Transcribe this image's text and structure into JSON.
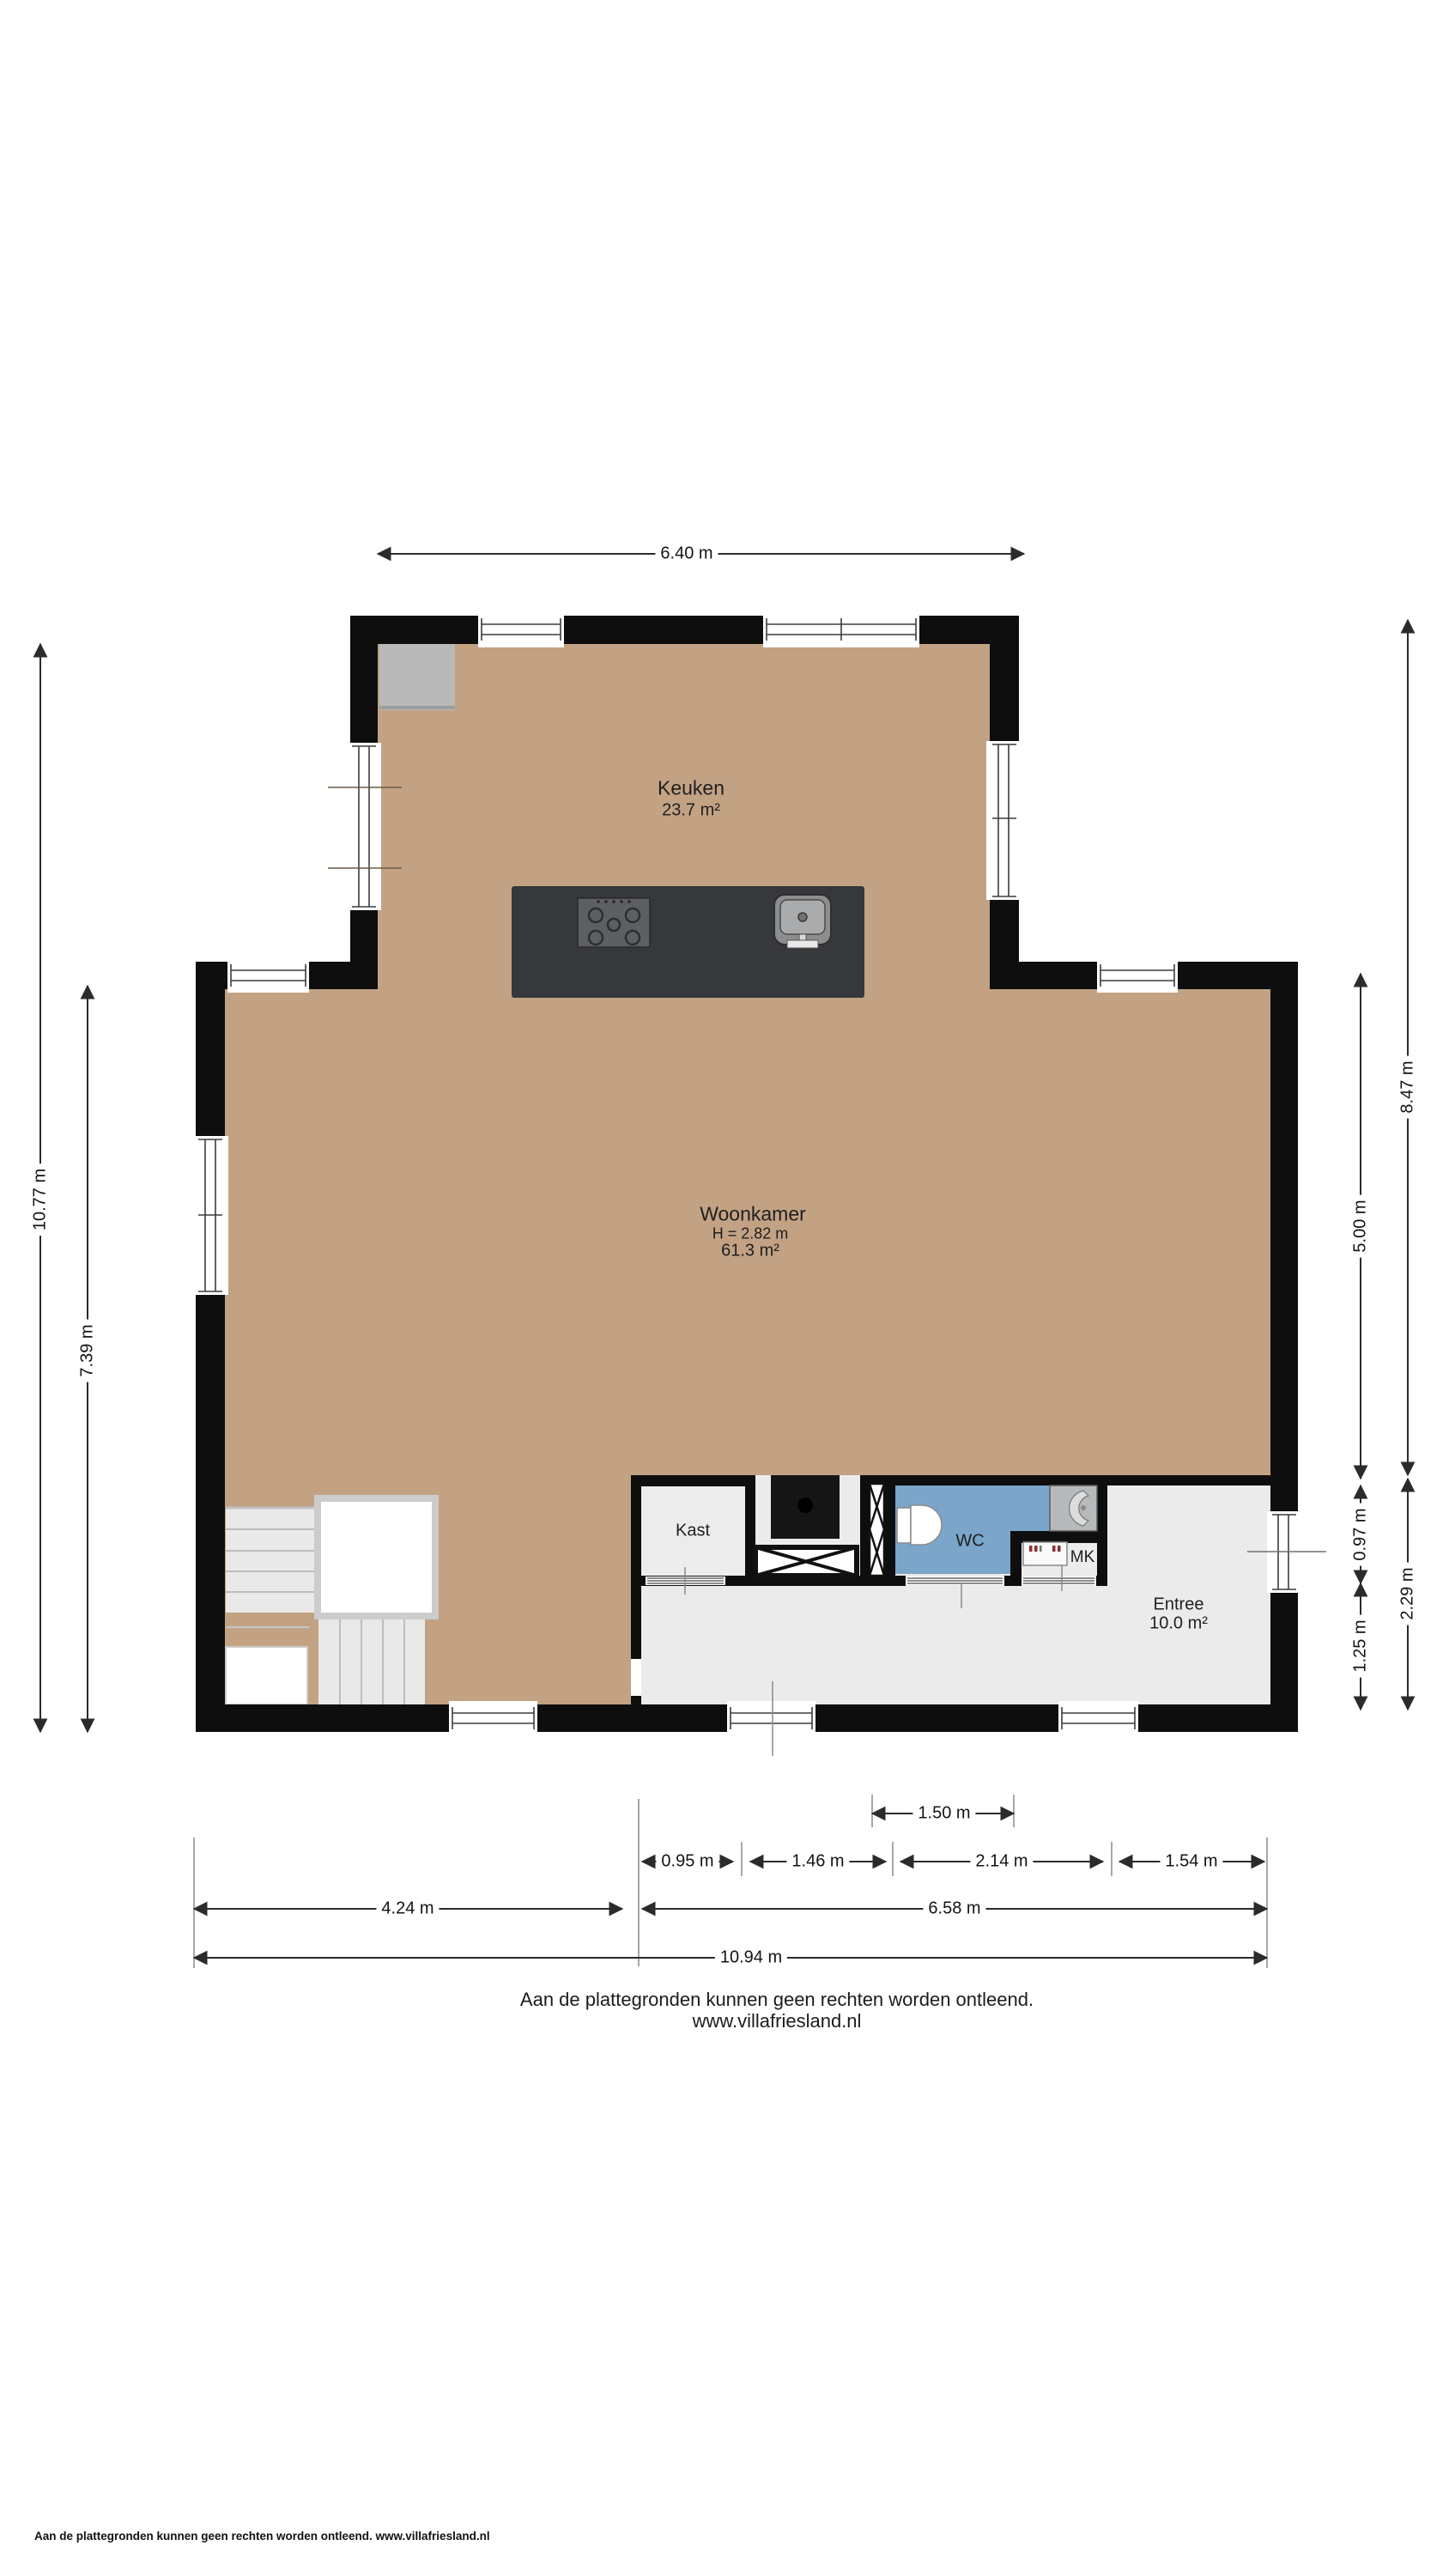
{
  "rooms": {
    "keuken": {
      "name": "Keuken",
      "area": "23.7 m²"
    },
    "woonkamer": {
      "name": "Woonkamer",
      "height": "H = 2.82 m",
      "area": "61.3 m²"
    },
    "kast": {
      "name": "Kast"
    },
    "wc": {
      "name": "WC"
    },
    "mk": {
      "name": "MK"
    },
    "entree": {
      "name": "Entree",
      "area": "10.0 m²"
    }
  },
  "dims": {
    "top": "6.40 m",
    "left_total": "10.77 m",
    "left_inner": "7.39 m",
    "right_top": "8.47 m",
    "right_mid": "5.00 m",
    "right_a": "0.97 m",
    "right_b": "1.25 m",
    "right_bottom": "2.29 m",
    "b1": "1.50 m",
    "row2": [
      "0.95 m",
      "1.46 m",
      "2.14 m",
      "1.54 m"
    ],
    "row3": [
      "4.24 m",
      "6.58 m"
    ],
    "row4": "10.94 m"
  },
  "notes": {
    "disclaimer_line1": "Aan de plattegronden kunnen geen rechten worden ontleend.",
    "disclaimer_line2": "www.villafriesland.nl",
    "footer": "Aan de plattegronden kunnen geen rechten worden ontleend. www.villafriesland.nl"
  },
  "colors": {
    "floor_tan": "#c3a284",
    "floor_wc_blue": "#7ba6c9",
    "floor_light": "#ebebeb",
    "wall_black": "#0e0e0e",
    "island_dark": "#36383b",
    "chimney_gray": "#b9b9b9"
  }
}
